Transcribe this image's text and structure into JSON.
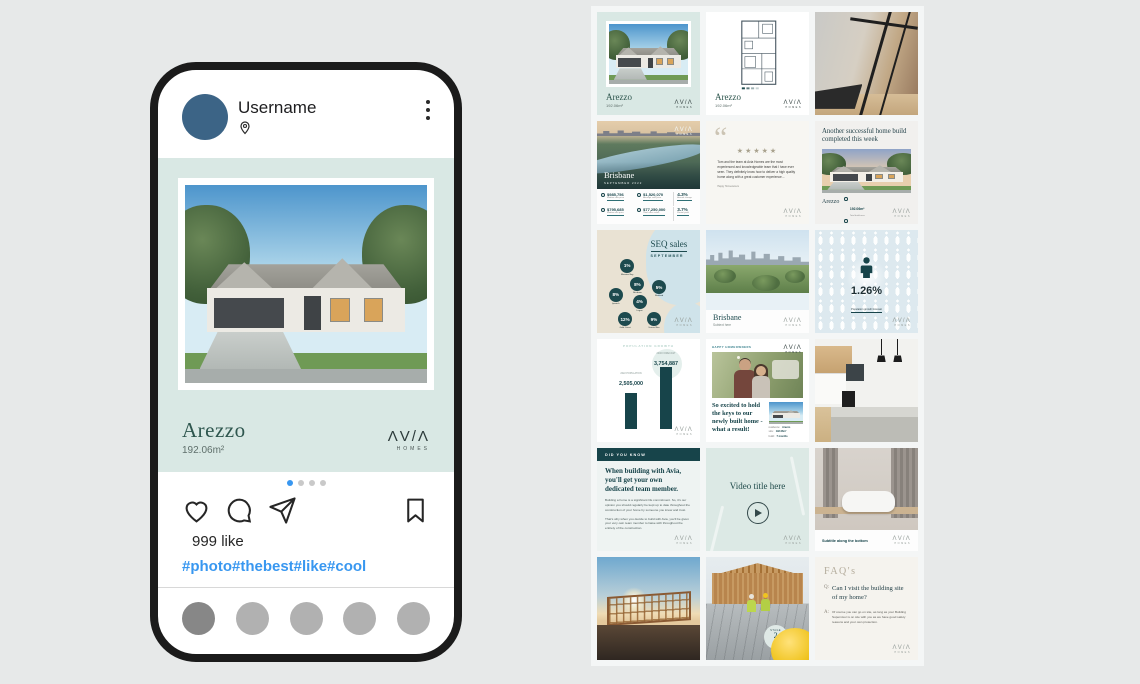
{
  "brand": {
    "display": "ΛV/Λ",
    "tagline": "HOMES"
  },
  "phone": {
    "username": "Username",
    "likes": "999 like",
    "hashtags": "#photo#thebest#like#cool",
    "post": {
      "title": "Arezzo",
      "area": "192.06m²"
    }
  },
  "grid": {
    "arezzo_exterior": {
      "title": "Arezzo",
      "subtitle": "192.06m²"
    },
    "arezzo_plan": {
      "title": "Arezzo",
      "subtitle": "192.06m²"
    },
    "brisbane_stats": {
      "title": "Brisbane",
      "subtitle": "SEPTEMBER 2022",
      "stats": [
        {
          "value": "$985,756",
          "label": "Median sale price"
        },
        {
          "value": "$1,520,070",
          "label": "Average sale price"
        },
        {
          "value": "$795,685",
          "label": "Median unit price"
        },
        {
          "value": "$77,250,000",
          "label": "Total sales value"
        }
      ],
      "percents": [
        {
          "value": "4.3%",
          "label": "Annual change"
        },
        {
          "value": "3.7%",
          "label": "Rental yield"
        }
      ]
    },
    "testimonial": {
      "stars": "★★★★★",
      "text": "Tom and the team at Avia Homes are the most experienced and knowledgeable team that I have ever seen. They definitely know how to deliver a high quality home along with a great customer experience...",
      "attribution": "Happy Homeowners"
    },
    "home_build": {
      "title": "Another successful home build completed this week",
      "name": "Arezzo",
      "stat1_value": "192.06m²",
      "stat1_label": "Total build area",
      "stat2_value": "7 months",
      "stat2_label": "Build duration"
    },
    "seq": {
      "title": "SEQ sales",
      "subtitle": "SEPTEMBER",
      "circles": [
        {
          "value": "1%",
          "label": "Moreton Bay"
        },
        {
          "value": "8%",
          "label": "Brisbane"
        },
        {
          "value": "5%",
          "label": "Redland"
        },
        {
          "value": "8%",
          "label": "Ipswich"
        },
        {
          "value": "4%",
          "label": "Logan"
        },
        {
          "value": "12%",
          "label": "Gold Coast"
        },
        {
          "value": "9%",
          "label": "Scenic Rim"
        }
      ]
    },
    "brisbane_photo": {
      "title": "Brisbane",
      "subtitle": "Subtext here"
    },
    "population_pct": {
      "value": "1.26%",
      "label": "Population growth forecast"
    },
    "population_chart": {
      "title": "POPULATION GROWTH",
      "bar1_label": "2022 POPULATION",
      "bar1_value": "2,505,000",
      "bar2_label": "2046 FORECAST",
      "bar2_value": "3,754,887"
    },
    "keys": {
      "tag": "HAPPY HOMEOWNERS",
      "quote": "So excited to hold the keys to our newly built home - what a result!",
      "details": [
        {
          "label": "residence:",
          "value": "Arezzo"
        },
        {
          "label": "size:",
          "value": "192.06m²"
        },
        {
          "label": "build:",
          "value": "7 months"
        }
      ]
    },
    "did_you_know": {
      "header": "DID YOU KNOW",
      "heading": "When building with Avia, you'll get your own dedicated team member.",
      "para1": "Building a home is a significant life commitment. So, it's our opinion you should regularly be kept up to date throughout the construction of your home by someone you know and trust.",
      "para2": "That's why when you decide to build with Avia, you'll be given your very own team member to liaise with throughout the entirety of the construction."
    },
    "video": {
      "title": "Video title here"
    },
    "bathroom": {
      "caption": "Subtitle along the bottom"
    },
    "stage": {
      "label": "STAGE",
      "number": "2"
    },
    "faq": {
      "header": "FAQ's",
      "q_prefix": "Q:",
      "question": "Can I visit the building site of my home?",
      "a_prefix": "A:",
      "answer": "Of course you can go on site, as long as your Building Supervisor is on site with you as we have good safety reasons and your own protection."
    }
  }
}
